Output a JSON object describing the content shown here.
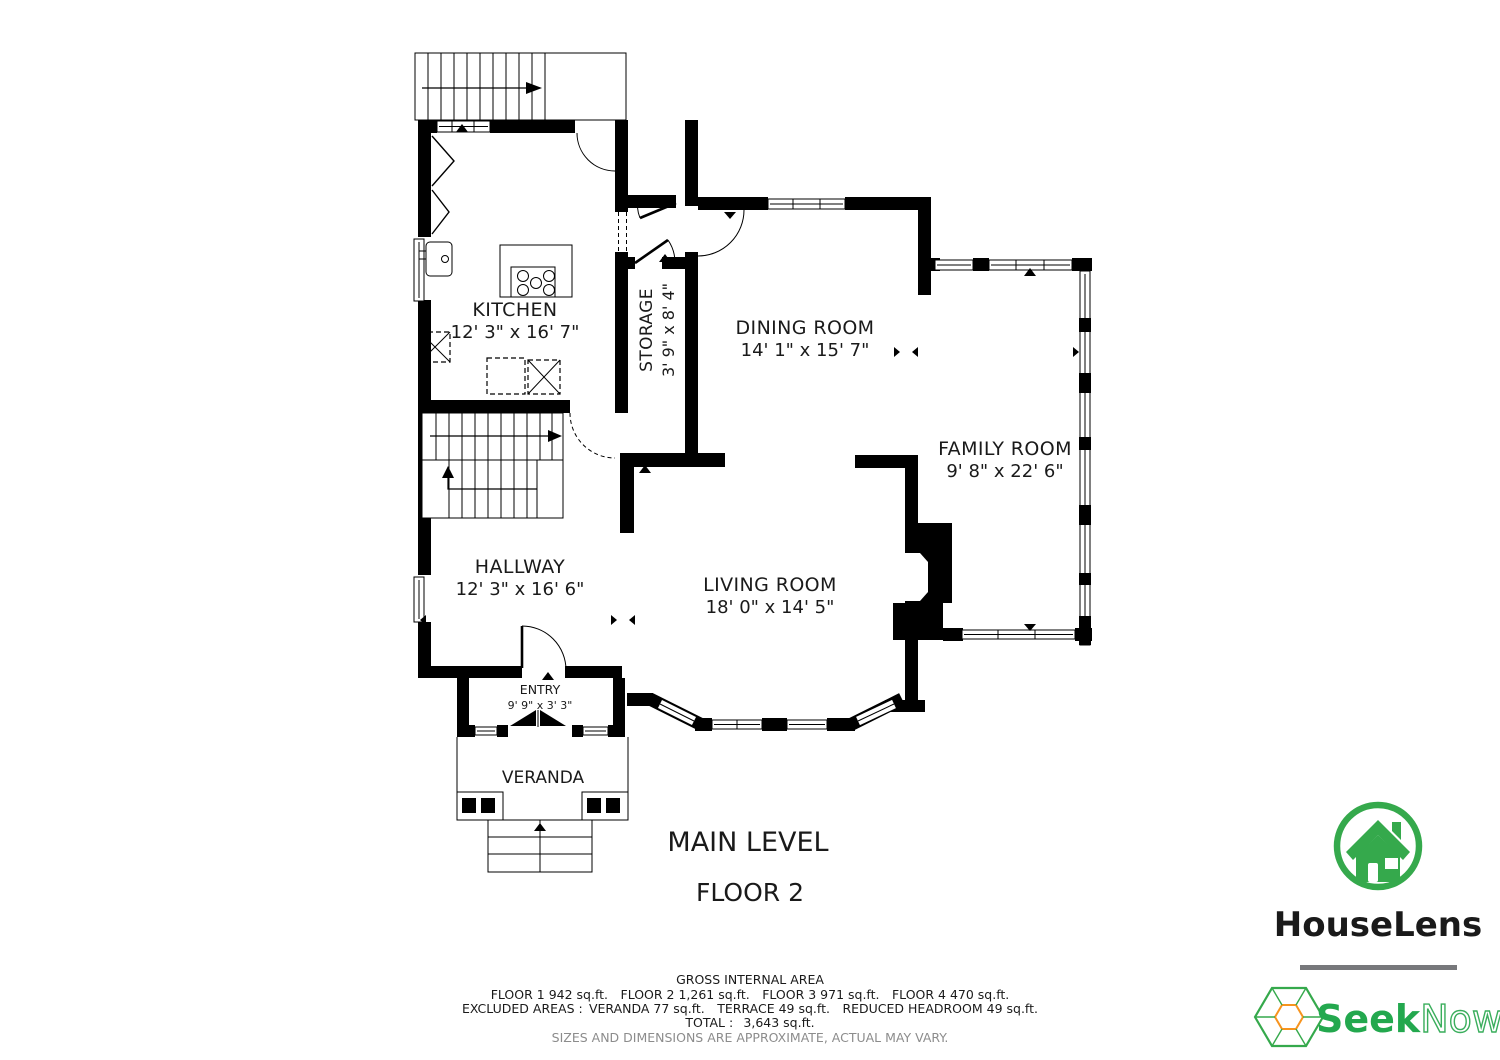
{
  "plan": {
    "rooms": [
      {
        "id": "kitchen",
        "name": "KITCHEN",
        "dims": "12' 3\" x 16' 7\""
      },
      {
        "id": "storage",
        "name": "STORAGE",
        "dims": "3' 9\" x 8' 4\""
      },
      {
        "id": "dining-room",
        "name": "DINING ROOM",
        "dims": "14' 1\" x 15' 7\""
      },
      {
        "id": "family-room",
        "name": "FAMILY ROOM",
        "dims": "9' 8\" x 22' 6\""
      },
      {
        "id": "hallway",
        "name": "HALLWAY",
        "dims": "12' 3\" x 16' 6\""
      },
      {
        "id": "living-room",
        "name": "LIVING ROOM",
        "dims": "18' 0\" x 14' 5\""
      },
      {
        "id": "entry",
        "name": "ENTRY",
        "dims": "9' 9\" x 3' 3\""
      },
      {
        "id": "veranda",
        "name": "VERANDA",
        "dims": ""
      }
    ],
    "level_title": "MAIN LEVEL",
    "floor_label": "FLOOR 2",
    "wall_color": "#000000"
  },
  "footer": {
    "gross_title": "GROSS INTERNAL AREA",
    "floors_line": "FLOOR 1 942 sq.ft. FLOOR 2 1,261 sq.ft. FLOOR 3 971 sq.ft. FLOOR 4 470 sq.ft.",
    "excluded_line": "EXCLUDED AREAS : VERANDA 77 sq.ft. TERRACE 49 sq.ft. REDUCED HEADROOM 49 sq.ft.",
    "total_line": "TOTAL :  3,643 sq.ft.",
    "disclaimer": "SIZES AND DIMENSIONS ARE APPROXIMATE, ACTUAL MAY VARY.",
    "disclaimer_color": "#8C8C8C"
  },
  "branding": {
    "houselens": {
      "name": "HouseLens",
      "color": "#35A94C"
    },
    "seeknow": {
      "name_bold": "Seek",
      "name_light": "Now.",
      "registered": "®",
      "color": "#23A84E",
      "light_color": "#3AAE5C",
      "accent": "#F7941E"
    },
    "divider_color": "#77787B"
  }
}
